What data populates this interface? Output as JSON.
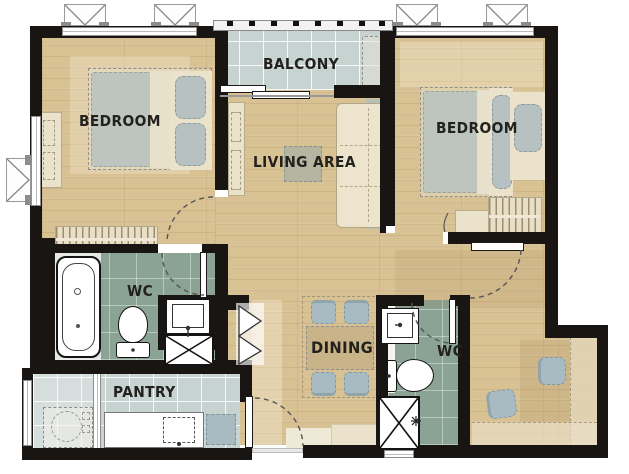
{
  "plan": {
    "title": "2-bedroom condominium unit floor plan",
    "rooms": [
      {
        "id": "bedroom-left",
        "label": "BEDROOM"
      },
      {
        "id": "balcony",
        "label": "BALCONY"
      },
      {
        "id": "living-area",
        "label": "LIVING AREA"
      },
      {
        "id": "bedroom-right",
        "label": "BEDROOM"
      },
      {
        "id": "wc-left",
        "label": "WC"
      },
      {
        "id": "dining",
        "label": "DINING"
      },
      {
        "id": "wc-right",
        "label": "WC"
      },
      {
        "id": "pantry",
        "label": "PANTRY"
      }
    ],
    "fixtures": [
      "double-bed",
      "single-bed",
      "wardrobe",
      "tv-console",
      "sofa",
      "coffee-table",
      "dining-table-4-chairs",
      "bathtub",
      "toilet",
      "wash-basin",
      "service-shaft",
      "kitchen-counter-sink",
      "stove",
      "washing-machine",
      "ac-condenser",
      "awning-window",
      "sliding-door",
      "balcony-railing",
      "built-in-desk",
      "floor-drain"
    ],
    "colors": {
      "wall": "#181512",
      "wood_floor": "#d8c193",
      "wc_tile": "#8ba395",
      "balcony_tile": "#c7d3d0",
      "furniture_beige": "#eae2cb",
      "furniture_gray": "#a9bbc2",
      "label_text": "#23211e"
    }
  }
}
